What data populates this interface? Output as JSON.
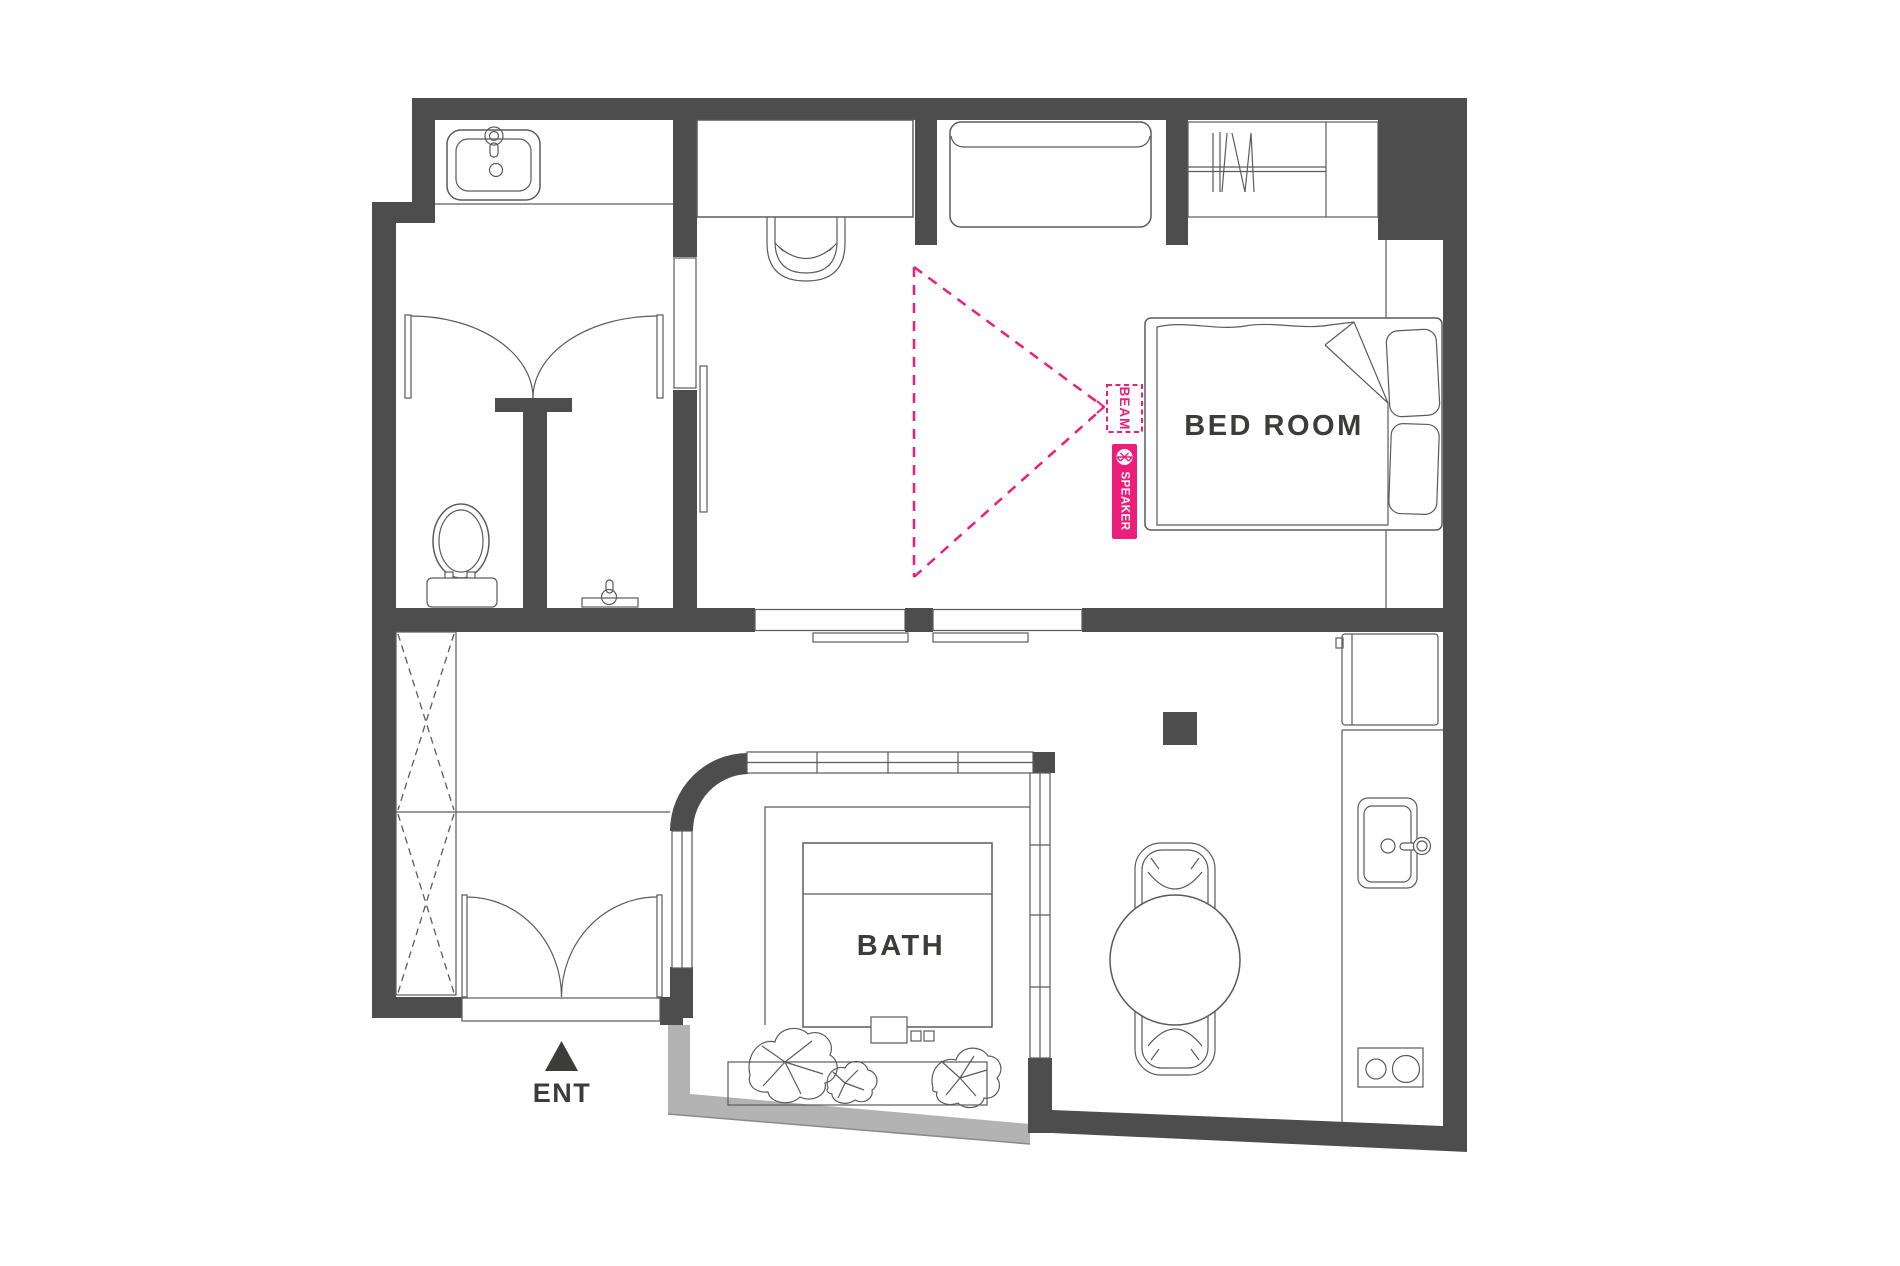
{
  "plan": {
    "type": "apartment-floor-plan",
    "labels": {
      "bedroom": "BED ROOM",
      "bath": "BATH",
      "entrance": "ENT",
      "beam": "BEAM",
      "speaker": "SPEAKER"
    },
    "rooms": [
      "bedroom",
      "bath",
      "workspace",
      "toilet-room",
      "powder-room",
      "vanity-bathroom",
      "entry-hall",
      "kitchen",
      "dining-area"
    ],
    "fixtures": [
      "vanity-sink",
      "toilet",
      "hand-basin",
      "desk",
      "desk-chair",
      "sofa",
      "wardrobe-with-hangers",
      "double-bed",
      "pillows",
      "bathtub",
      "planter-plants",
      "fridge",
      "kitchen-sink",
      "cooktop",
      "round-table",
      "dining-chairs",
      "storage-closet-x"
    ],
    "annotation": {
      "device": "bluetooth-speaker",
      "beam_direction": "pointing-left-from-bedroom-wall"
    },
    "icons": {
      "speaker_badge": "bluetooth-icon",
      "entrance_marker": "triangle-up-icon"
    }
  },
  "colors": {
    "wall": "#4d4d4d",
    "line": "#5b5b5b",
    "accent": "#ed1e79",
    "text": "#3c3c3b",
    "ledge": "#b3b3b3",
    "background": "#ffffff"
  }
}
